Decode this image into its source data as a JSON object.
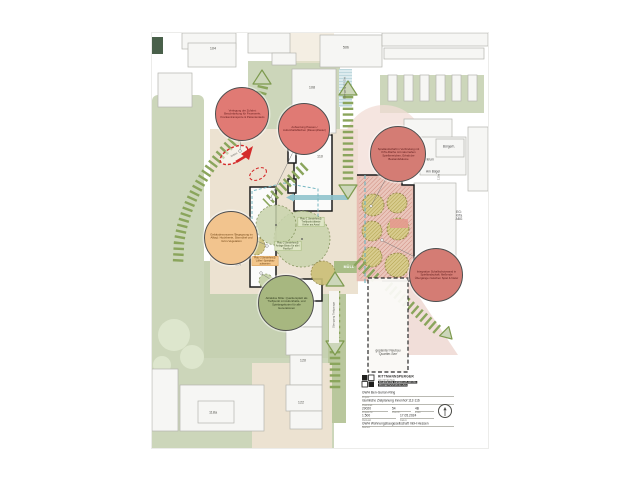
{
  "document": {
    "kind": "architectural site plan",
    "sheet": "urban courtyard redesign concept plan with annotation callouts"
  },
  "colors": {
    "area_green": "#ccd6ba",
    "path_green": "#8aa55c",
    "beige": "#ece2d1",
    "teal": "#74b6c0",
    "alert_red": "#d42b2b",
    "callout_red": "#e07a74",
    "callout_orange": "#f2c48e",
    "callout_green": "#a7b780",
    "kita_pink": "#eac6bc",
    "tree_olive": "#d8cc8e"
  },
  "map_labels": {
    "b104": "104",
    "b50b": "50b",
    "b108": "108",
    "b110": "110",
    "b112": "112",
    "b114": "114",
    "b116": "116",
    "b118": "118",
    "b120": "120",
    "b122": "122",
    "b118a": "118a",
    "b110a": "110a",
    "zentrum": "Zentrum",
    "am_buegel": "Am Bügel",
    "buergerh": "Bürgerh.",
    "kita": "EG: KiTa ABG",
    "muell": "MÜLL"
  },
  "annotations": {
    "uebergang_ost": "Übergang QS Ost",
    "uebergang_tg": "Übergang Tiefgarage",
    "zufahrt": "Zufahrt",
    "neubau": "geplanter Neubau 'Quartier-See'",
    "platz1": "Platz 1 (bestehend): Treffpunkt älteste Kiefer am Areal",
    "platz2": "Platz 2 (bestehend): Anlage Bistro für alle / Pavillon?",
    "platz3": "Platz 3 (bestehend): 'Lilifee'-Spielplatz aufwerten"
  },
  "callouts": {
    "access": {
      "text": "Verlegung der Zufahrt: Beschränkung für Feuerwehr, Krankentransporte & Patiententaxis",
      "color": "#e07a74"
    },
    "pause": {
      "text": "Aufwertung Pausen-/ Aufenthaltsflächen (Rasenpflaster)",
      "color": "#e07a74"
    },
    "playscape": {
      "text": "Spiellandschaft in Verbindung mit KiTa-Fläche mit naturnahen Spielbereichen, Erhalt der Bestandsbäume",
      "color": "#d47c74"
    },
    "noise": {
      "text": "Integration Schallschutzwand in Spiellandschaft: fließende Übergänge zwischen Spiel & Natur",
      "color": "#d47c74"
    },
    "forecourt": {
      "text": "Gebäudevorzonen 'Begegnung im Alltag': Hochbeete, Sitzmöbel und Grün-Vegetation",
      "color": "#f2c48e"
    },
    "centre": {
      "text": "Attraktive Mitte: Quartiersplatz als Treffpunkt mit Aufenthalts- und Spielangeboten für alle Generationen",
      "color": "#a7b780"
    }
  },
  "titleblock": {
    "firm": "RITTMANNSPERGER",
    "firm_line1": "ARCHITEKTEN",
    "firm_line2": "INGENIEURE GENERALPLANUNG",
    "firm_line3": "PROJEKTENTWICKLUNG",
    "project_label": "Projekt",
    "project": "GWH Ben-Gurion-Ring",
    "content_label": "Planinhalt",
    "content": "räumliche Zielplanung Innenhof 112-116",
    "projnr_label": "Projekt-Nr.",
    "projnr": "29020",
    "plannr_label": "Plan-Nr.",
    "plannr": "54",
    "index_label": "Index",
    "index": "4B",
    "scale_label": "Maßstab",
    "scale": "1:500",
    "date_label": "Datum",
    "date": "17.05.2024",
    "client_label": "Bauherr",
    "client": "GWH Wohnungsbaugesellschaft mbH Hessen"
  }
}
